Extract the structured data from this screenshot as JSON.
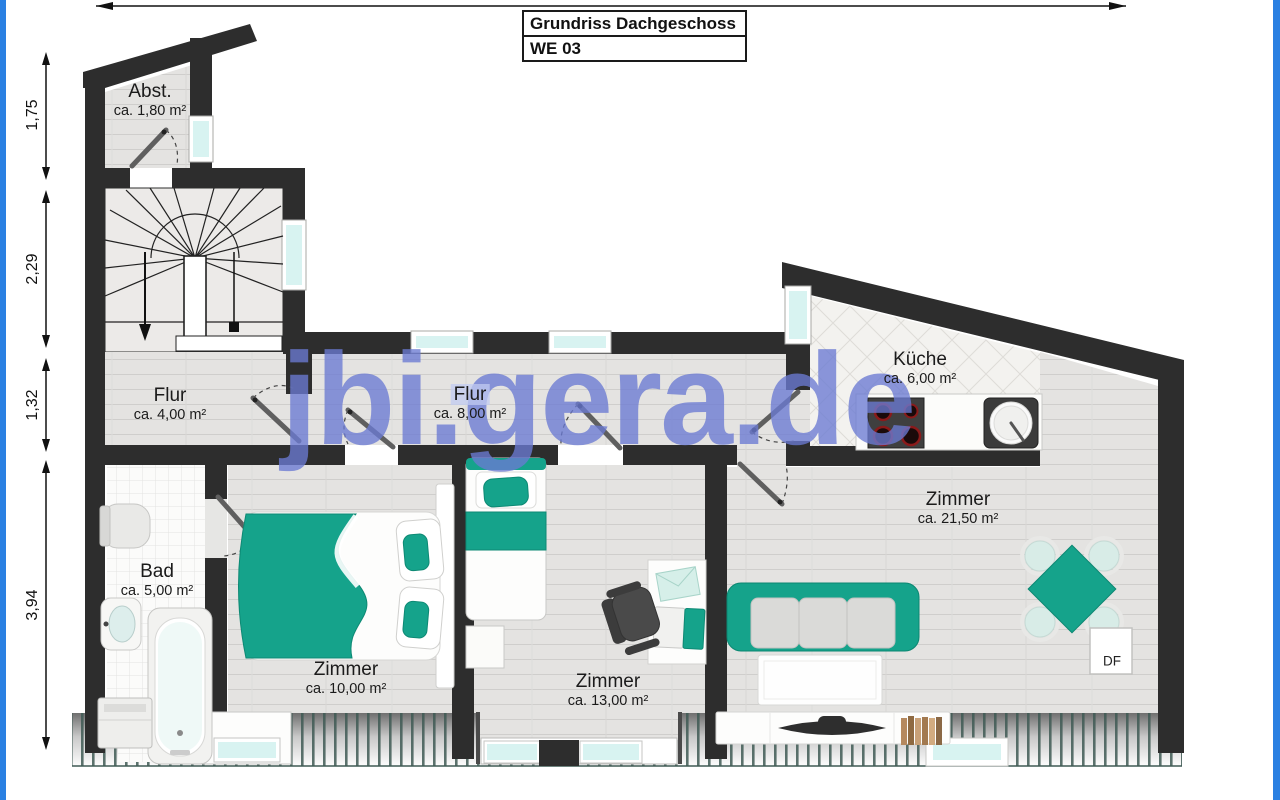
{
  "title_block": {
    "line1": "Grundriss Dachgeschoss",
    "line2": "WE 03"
  },
  "watermark": {
    "text": "jbi.gera.de"
  },
  "rooms": {
    "abst": {
      "name": "Abst.",
      "area": "ca. 1,80 m²"
    },
    "flur4": {
      "name": "Flur",
      "area": "ca. 4,00 m²"
    },
    "flur8": {
      "name": "Flur",
      "area": "ca. 8,00 m²"
    },
    "kueche": {
      "name": "Küche",
      "area": "ca. 6,00 m²"
    },
    "bad": {
      "name": "Bad",
      "area": "ca. 5,00 m²"
    },
    "zimmer10": {
      "name": "Zimmer",
      "area": "ca. 10,00 m²"
    },
    "zimmer13": {
      "name": "Zimmer",
      "area": "ca. 13,00 m²"
    },
    "zimmer21": {
      "name": "Zimmer",
      "area": "ca. 21,50 m²"
    }
  },
  "dimensions": {
    "left": [
      "1,75",
      "2,29",
      "1,32",
      "3,94"
    ]
  },
  "annotations": {
    "roof_window_label": "DF"
  },
  "colors": {
    "accent_teal": "#15a38b",
    "wall": "#2d2d2d",
    "window_glass": "#d8f3f1",
    "frame_blue": "#2a80e2",
    "watermark_blue": "#6a7cd4"
  }
}
